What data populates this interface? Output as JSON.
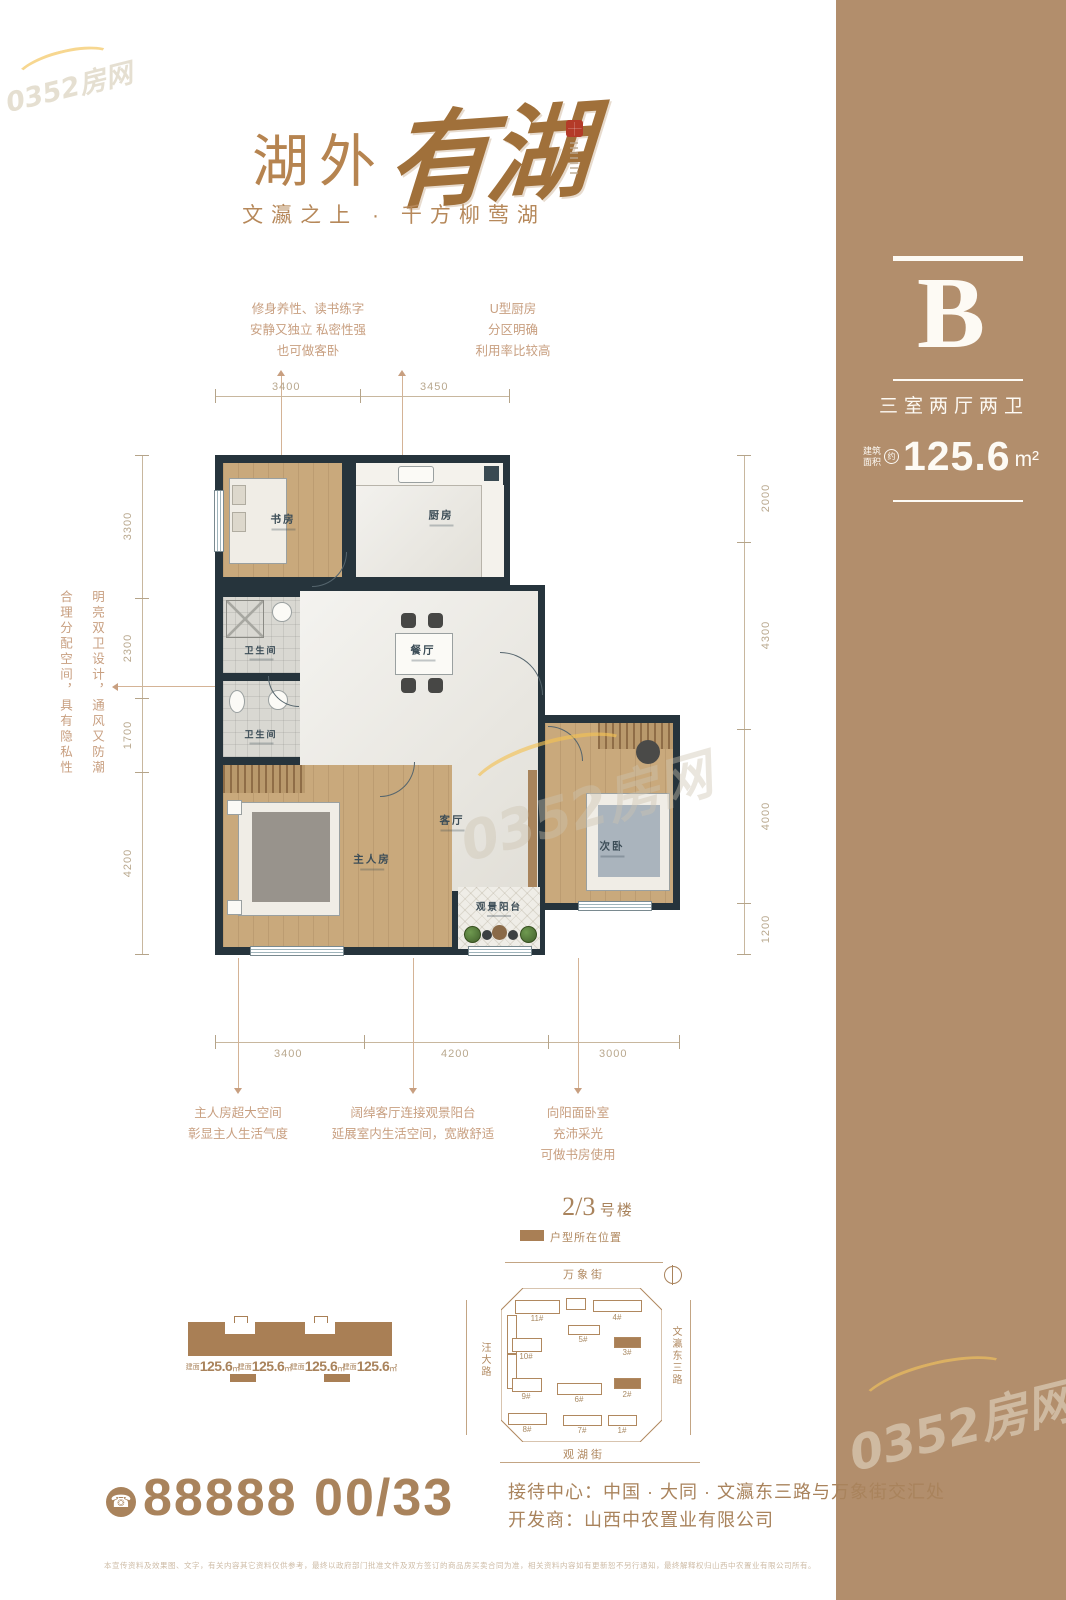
{
  "watermark": {
    "text": "0352房网"
  },
  "header": {
    "title_prefix": "湖外",
    "title_script": "有湖",
    "subtitle": "文瀛之上 · 千方柳莺湖"
  },
  "sidebar": {
    "unit_letter": "B",
    "unit_type": "三室两厅两卫",
    "area_label_line1": "建筑",
    "area_label_line2": "面积",
    "area_approx": "约",
    "area_value": "125.6",
    "area_unit": "m²",
    "accent_color": "#b28e6c"
  },
  "floorplan": {
    "rooms": [
      {
        "name": "书房"
      },
      {
        "name": "厨房"
      },
      {
        "name": "餐厅"
      },
      {
        "name": "卫生间"
      },
      {
        "name": "卫生间"
      },
      {
        "name": "主人房"
      },
      {
        "name": "客厅"
      },
      {
        "name": "次卧"
      },
      {
        "name": "观景阳台"
      }
    ],
    "dims": {
      "top": [
        "3400",
        "3450"
      ],
      "left": [
        "3300",
        "2300",
        "1700",
        "4200"
      ],
      "right": [
        "2000",
        "4300",
        "4000",
        "1200"
      ],
      "bottom": [
        "3400",
        "4200",
        "3000"
      ]
    }
  },
  "annotations": {
    "study": [
      "修身养性、读书练字",
      "安静又独立 私密性强",
      "也可做客卧"
    ],
    "kitchen": [
      "U型厨房",
      "分区明确",
      "利用率比较高"
    ],
    "baths": [
      "明亮双卫设计，通风又防潮",
      "合理分配空间，具有隐私性"
    ],
    "master": [
      "主人房超大空间",
      "彰显主人生活气度"
    ],
    "living": [
      "阔绰客厅连接观景阳台",
      "延展室内生活空间，宽敞舒适"
    ],
    "bedroom": [
      "向阳面卧室",
      "充沛采光",
      "可做书房使用"
    ]
  },
  "siteplan": {
    "title_num": "2/3",
    "title_suffix": "号楼",
    "legend": "户型所在位置",
    "streets": {
      "top": "万象街",
      "bottom": "观湖街",
      "left": "汪大路",
      "right": "文瀛东三路"
    },
    "buildings": [
      {
        "label": "11#"
      },
      {
        "label": "4#"
      },
      {
        "label": "5#"
      },
      {
        "label": "3#",
        "highlight": true
      },
      {
        "label": "10#"
      },
      {
        "label": "9#"
      },
      {
        "label": "6#"
      },
      {
        "label": "2#",
        "highlight": true
      },
      {
        "label": "8#"
      },
      {
        "label": "7#"
      },
      {
        "label": "1#"
      }
    ]
  },
  "elevation": {
    "unit_prefix": "建面",
    "unit_value": "125.6",
    "unit_unit": "㎡"
  },
  "contact": {
    "phone": "88888 00/33",
    "reception": "接待中心：中国 · 大同 · 文瀛东三路与万象街交汇处",
    "developer": "开发商：山西中农置业有限公司",
    "disclaimer": "本宣传资料及效果图、文字，有关内容其它资料仅供参考，最终以政府部门批准文件及双方签订的商品房买卖合同为准，相关资料内容如有更新恕不另行通知，最终解释权归山西中农置业有限公司所有。"
  },
  "icons": {
    "phone": "☎"
  }
}
